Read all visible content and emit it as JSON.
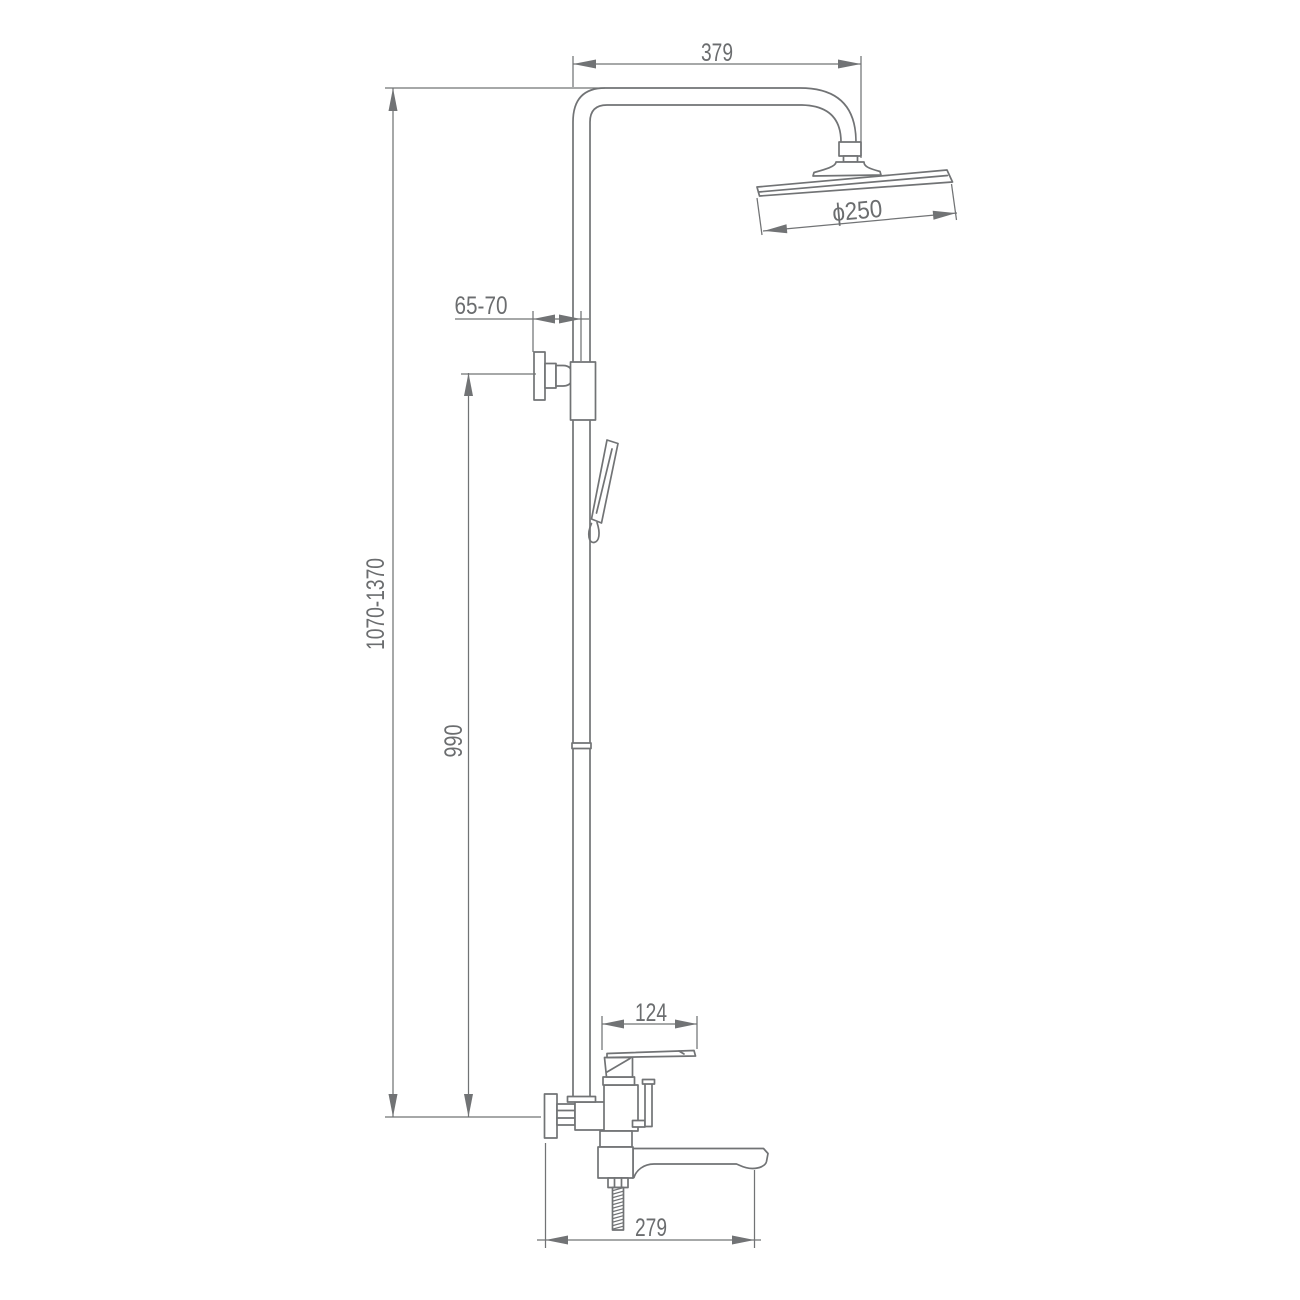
{
  "drawing": {
    "title": "shower-system-technical-drawing",
    "labels": {
      "arm_reach": "379",
      "head_diameter": "ϕ250",
      "wall_distance": "65-70",
      "total_height": "1070-1370",
      "riser_height": "990",
      "mixer_width": "124",
      "spout_reach": "279"
    },
    "colors": {
      "line": "#717375",
      "text": "#6b6d6f",
      "background": "#ffffff"
    }
  }
}
